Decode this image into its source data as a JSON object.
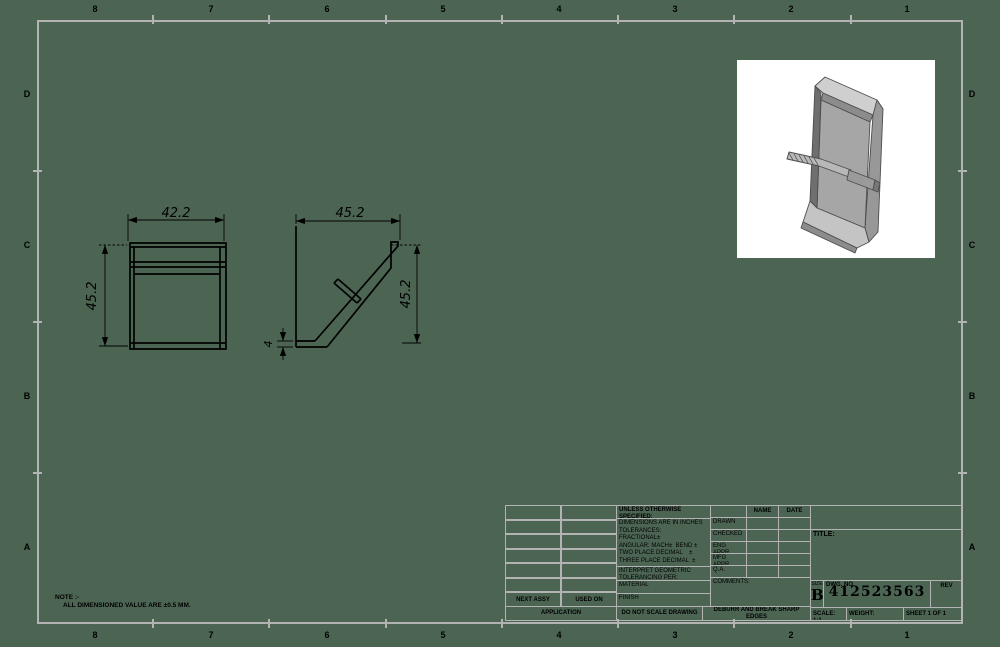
{
  "sheet": {
    "zone_columns": [
      "8",
      "7",
      "6",
      "5",
      "4",
      "3",
      "2",
      "1"
    ],
    "zone_rows": [
      "D",
      "C",
      "B",
      "A"
    ],
    "note_line1": "NOTE :-",
    "note_line2": "ALL DIMENSIONED VALUE ARE ±0.5 MM."
  },
  "views": {
    "front": {
      "width_dim": "42.2",
      "height_dim": "45.2"
    },
    "side": {
      "width_dim": "45.2",
      "height_dim": "45.2",
      "thickness_dim": "4"
    }
  },
  "title_block": {
    "unless_header": "UNLESS OTHERWISE SPECIFIED:",
    "tol_lines": [
      "DIMENSIONS ARE IN INCHES",
      "TOLERANCES:",
      "FRACTIONAL±",
      "ANGULAR: MACH±  BEND ±",
      "TWO PLACE DECIMAL    ±",
      "THREE PLACE DECIMAL  ±"
    ],
    "interpret": "INTERPRET GEOMETRIC TOLERANCING PER:",
    "material_label": "MATERIAL",
    "finish_label": "FINISH",
    "do_not_scale": "DO NOT SCALE DRAWING",
    "deburr": "DEBURR AND BREAK SHARP EDGES",
    "next_assy": "NEXT ASSY",
    "used_on": "USED ON",
    "application_label": "APPLICATION",
    "name_header": "NAME",
    "date_header": "DATE",
    "rows": [
      "DRAWN",
      "CHECKED",
      "ENG APPR.",
      "MFG APPR.",
      "Q.A.",
      "COMMENTS:"
    ],
    "title_label": "TITLE:",
    "size_label": "SIZE",
    "size_value": "B",
    "dwg_label": "DWG. NO.",
    "dwg_number": "412523563",
    "rev_label": "REV",
    "scale_label": "SCALE: 1:1",
    "weight_label": "WEIGHT:",
    "sheet_label": "SHEET 1 OF 1"
  }
}
